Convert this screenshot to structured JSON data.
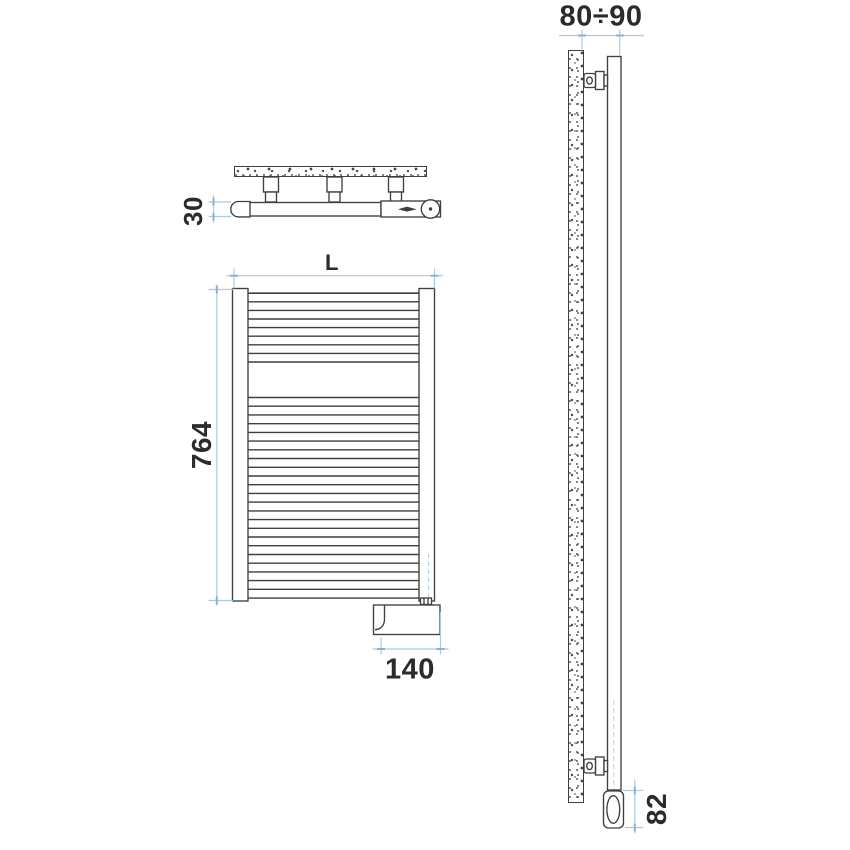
{
  "drawing": {
    "colors": {
      "line": "#3f3f3f",
      "dimension_line": "#a9cbe2",
      "dimension_tick": "#86b2d4",
      "centerline": "#b9d5ea",
      "label_text": "#2b2b2b",
      "background": "#ffffff"
    },
    "labels": {
      "top_depth": "30",
      "front_width": "L",
      "front_height": "764",
      "front_element_width": "140",
      "side_wall_distance": "80÷90",
      "side_element_height": "82"
    }
  }
}
